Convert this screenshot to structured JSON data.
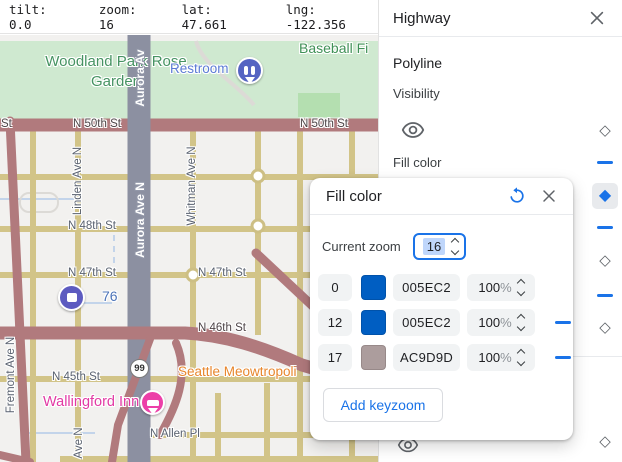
{
  "status_bar": {
    "items": [
      "tilt: 0.0",
      "zoom: 16",
      "lat: 47.661",
      "lng: -122.356"
    ]
  },
  "map": {
    "labels": {
      "park": "Woodland Park Rose Garden",
      "restroom": "Restroom",
      "baseball": "Baseball Fi",
      "aurora_top": "Aurora Av",
      "aurora_mid": "Aurora Ave N",
      "n50th_frag": "St",
      "n50th_a": "N 50th St",
      "n50th_b": "N 50th St",
      "linden": "Linden Ave N",
      "whitman": "Whitman Ave N",
      "n48th": "N 48th St",
      "n47th_a": "N 47th St",
      "n47th_b": "N 47th St",
      "n46th": "N 46th St",
      "n45th": "N 45th St",
      "n_allen": "N Allen Pl",
      "fremont": "Fremont Ave N",
      "ave_n": "Ave N",
      "seattle_poi": "Seattle Meowtropoli",
      "wallingford_poi": "Wallingford Inn",
      "gas_poi": "76",
      "route99": "99"
    }
  },
  "panel": {
    "title": "Highway",
    "section": "Polyline",
    "visibility_label": "Visibility",
    "fill_color_label": "Fill color"
  },
  "popup": {
    "title": "Fill color",
    "current_zoom_label": "Current zoom",
    "current_zoom_value": "16",
    "percent_sign": "%",
    "rows": [
      {
        "zoom": "0",
        "hex": "005EC2",
        "color": "#005EC2",
        "opacity": "100"
      },
      {
        "zoom": "12",
        "hex": "005EC2",
        "color": "#005EC2",
        "opacity": "100"
      },
      {
        "zoom": "17",
        "hex": "AC9D9D",
        "color": "#AC9D9D",
        "opacity": "100"
      }
    ],
    "add_button": "Add keyzoom"
  },
  "colors": {
    "accent_blue": "#1a73e8",
    "keyzoom_blue": "#005EC2",
    "keyzoom_taupe": "#AC9D9D",
    "highway_red": "#b17a7d",
    "road_khaki": "#d2c488",
    "aurora_gray": "#8c90a1",
    "park_green": "#cfe9d0"
  }
}
